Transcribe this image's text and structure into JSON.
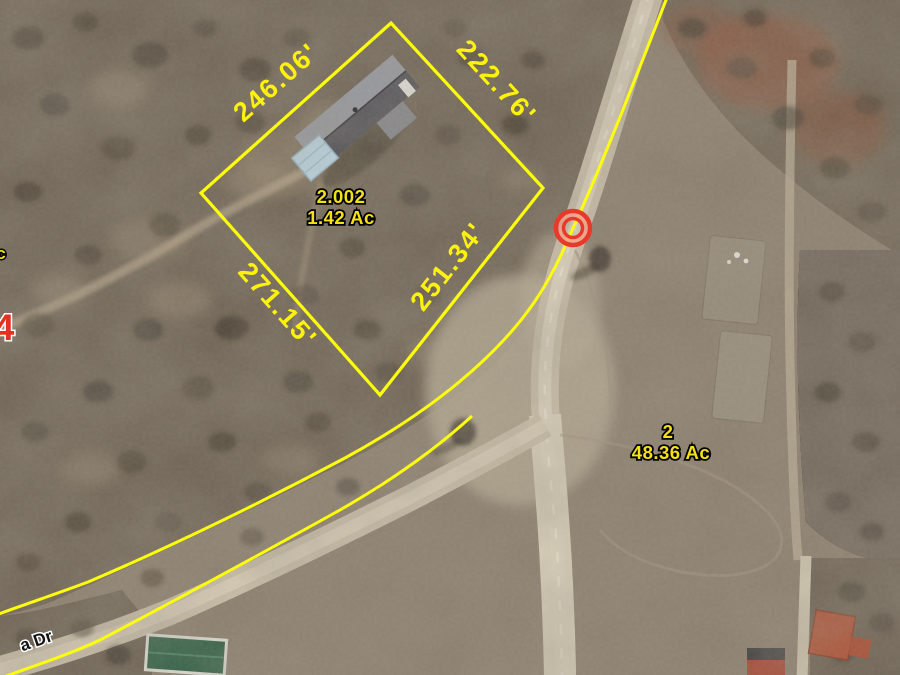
{
  "map": {
    "focus_parcel": {
      "id": "2.002",
      "area": "1.42 Ac",
      "dimensions": [
        "246.06'",
        "222.76'",
        "271.15'",
        "251.34'"
      ]
    },
    "adjacent_parcel": {
      "id": "2",
      "area": "48.36 Ac"
    },
    "road_name_partial": "a Dr",
    "route_number_partial": "4",
    "area_label_partial": "c",
    "marker": {
      "type": "selected-point-double-ring",
      "color": "#e8392a"
    },
    "overlay_colors": {
      "boundary_yellow": "#fdfd0e",
      "dimension_text": "#fdf20e",
      "parcel_text": "#f5e114",
      "route_text": "#e33122",
      "road_text": "#141414"
    }
  }
}
